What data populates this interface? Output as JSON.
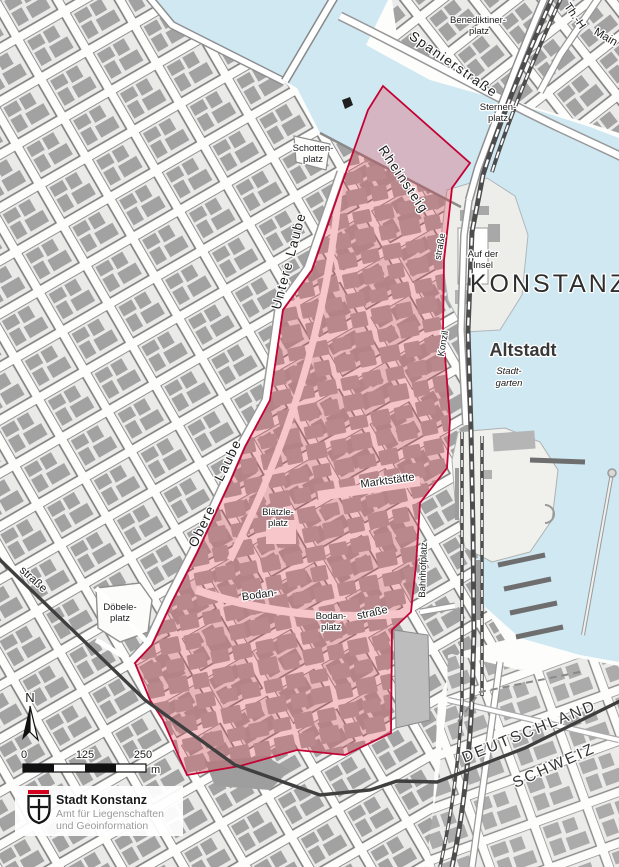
{
  "colors": {
    "water": "#cfe8f2",
    "land": "#ffffff",
    "block_fill": "#eaeae8",
    "block_stroke": "#7d7d7d",
    "building": "#a2a2a2",
    "zone_fill": "rgba(228,50,70,0.28)",
    "zone_border": "#c40233",
    "rail": "#4d4d4d",
    "border_line": "#3f3f3f",
    "logo_red": "#d6001c"
  },
  "labels": {
    "city": "KONSTANZ",
    "district": "Altstadt",
    "germany": "DEUTSCHLAND",
    "switzerland": "SCHWEIZ",
    "benediktinerplatz_1": "Benediktiner-",
    "benediktinerplatz_2": "platz",
    "sternenplatz_1": "Sternen-",
    "sternenplatz_2": "platz",
    "schottenplatz_1": "Schotten-",
    "schottenplatz_2": "platz",
    "auf_der_insel_1": "Auf der",
    "auf_der_insel_2": "Insel",
    "stadtgarten_1": "Stadt-",
    "stadtgarten_2": "garten",
    "blaetzleplatz_1": "Blätzle-",
    "blaetzleplatz_2": "platz",
    "bodanplatz_1": "Bodan-",
    "bodanplatz_2": "platz",
    "doebeleplatz_1": "Döbele-",
    "doebeleplatz_2": "platz",
    "spanierstrasse": "Spanierstraße",
    "rheinsteig": "Rheinsteig",
    "untere_laube": "Untere Laube",
    "obere": "Obere",
    "laube": "Laube",
    "marktstaette": "Marktstätte",
    "bodan": "Bodan-",
    "bodanstrasse": "straße",
    "konzilstrasse_1": "straße",
    "konzilstrasse_2": "Konzil",
    "bahnhofplatz": "Bahnhofplatz",
    "strasse_left": "straße",
    "th_h": "Th.-H",
    "mainau": "Main"
  },
  "scale_bar": {
    "tick_0": "0",
    "tick_125": "125",
    "tick_250": "250",
    "unit": "m"
  },
  "compass": {
    "north": "N"
  },
  "logo": {
    "title": "Stadt Konstanz",
    "subtitle_1": "Amt für Liegenschaften",
    "subtitle_2": "und Geoinformation"
  }
}
